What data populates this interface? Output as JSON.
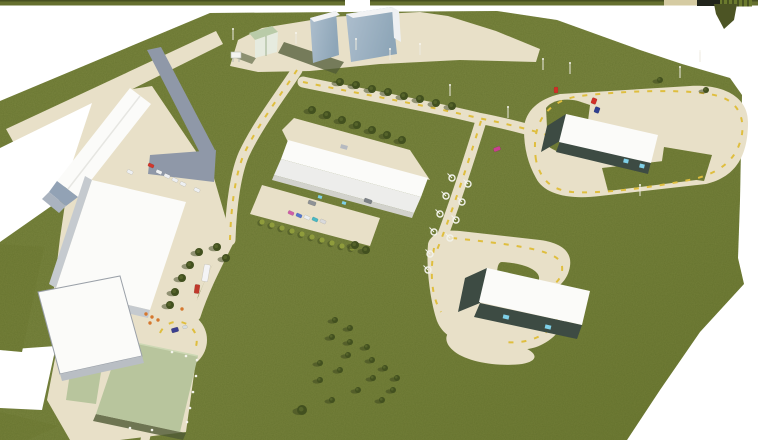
{
  "image_type": "aerial-3d-site-plan-rendering",
  "colors": {
    "background": "#ffffff",
    "grass": "#76813b",
    "grass_dark": "#68742f",
    "pad_green": "#b8c59d",
    "pavement": "#e8e0c8",
    "road_gray": "#8f98a8",
    "roof_white": "#fbfbf9",
    "roof_shaded": "#ededeb",
    "wall_gray": "#c5cacf",
    "wall_dark": "#3d4b43",
    "glass_blue": "#9db3c4",
    "roof_green": "#b9cba8",
    "marking_yellow": "#dfbe3e",
    "tree_dark": "#42501f",
    "tree_mid": "#55632a",
    "bush_yellow": "#8f9c3c",
    "shadow_dark": "#4f5a35",
    "bar_olive": "#66702f",
    "bar_tan": "#d5cba2",
    "bar_black": "#22251c",
    "door_glow": "#7fd0e8"
  },
  "scene": {
    "trees": [
      [
        340,
        82,
        4
      ],
      [
        356,
        85,
        4
      ],
      [
        372,
        89,
        4
      ],
      [
        388,
        92,
        4
      ],
      [
        404,
        96,
        4
      ],
      [
        420,
        99,
        4
      ],
      [
        436,
        103,
        4
      ],
      [
        452,
        106,
        4
      ],
      [
        312,
        110,
        4
      ],
      [
        327,
        115,
        4
      ],
      [
        342,
        120,
        4
      ],
      [
        357,
        125,
        4
      ],
      [
        372,
        130,
        4
      ],
      [
        387,
        135,
        4
      ],
      [
        402,
        140,
        4
      ],
      [
        199,
        252,
        4
      ],
      [
        190,
        265,
        4
      ],
      [
        182,
        278,
        4
      ],
      [
        175,
        292,
        4
      ],
      [
        170,
        305,
        4
      ],
      [
        217,
        247,
        4
      ],
      [
        226,
        258,
        4
      ],
      [
        355,
        245,
        4
      ],
      [
        366,
        250,
        4
      ],
      [
        335,
        320,
        3
      ],
      [
        350,
        328,
        3
      ],
      [
        332,
        337,
        3
      ],
      [
        350,
        342,
        3
      ],
      [
        367,
        347,
        3
      ],
      [
        348,
        355,
        3
      ],
      [
        372,
        360,
        3
      ],
      [
        320,
        363,
        3
      ],
      [
        385,
        368,
        3
      ],
      [
        340,
        370,
        3
      ],
      [
        373,
        378,
        3
      ],
      [
        397,
        378,
        3
      ],
      [
        320,
        380,
        3
      ],
      [
        358,
        390,
        3
      ],
      [
        393,
        390,
        3
      ],
      [
        332,
        400,
        3
      ],
      [
        382,
        400,
        3
      ],
      [
        302,
        410,
        5
      ],
      [
        660,
        80,
        3
      ],
      [
        706,
        90,
        3
      ]
    ],
    "bushes": [
      [
        262,
        222
      ],
      [
        272,
        225
      ],
      [
        282,
        228
      ],
      [
        292,
        231
      ],
      [
        302,
        234
      ],
      [
        312,
        237
      ],
      [
        322,
        240
      ],
      [
        332,
        243
      ],
      [
        342,
        246
      ],
      [
        352,
        248
      ]
    ],
    "lamps": [
      [
        452,
        178
      ],
      [
        446,
        196
      ],
      [
        440,
        214
      ],
      [
        434,
        232
      ],
      [
        468,
        184
      ],
      [
        462,
        202
      ],
      [
        456,
        220
      ],
      [
        450,
        238
      ],
      [
        430,
        254
      ],
      [
        428,
        270
      ]
    ],
    "poles": [
      [
        233,
        40
      ],
      [
        296,
        44
      ],
      [
        356,
        50
      ],
      [
        420,
        55
      ],
      [
        450,
        96
      ],
      [
        508,
        118
      ],
      [
        543,
        70
      ],
      [
        570,
        74
      ],
      [
        680,
        78
      ],
      [
        390,
        60
      ],
      [
        640,
        196
      ],
      [
        700,
        62
      ]
    ],
    "posts": [
      [
        172,
        352
      ],
      [
        186,
        356
      ],
      [
        197,
        360
      ],
      [
        196,
        376
      ],
      [
        193,
        392
      ],
      [
        190,
        408
      ],
      [
        187,
        422
      ],
      [
        152,
        430
      ],
      [
        130,
        428
      ]
    ],
    "flowers": [
      [
        146,
        314
      ],
      [
        152,
        317
      ],
      [
        158,
        320
      ],
      [
        150,
        323
      ],
      [
        182,
        309
      ]
    ],
    "vehicles": [
      {
        "n": "parking-car-pink",
        "x": 291,
        "y": 213,
        "w": 6,
        "h": 3.5,
        "a": 25,
        "c": "#cf5fa8"
      },
      {
        "n": "parking-car-blue",
        "x": 299,
        "y": 215.5,
        "w": 6,
        "h": 3.5,
        "a": 25,
        "c": "#5577cc"
      },
      {
        "n": "parking-car-white",
        "x": 307,
        "y": 217.5,
        "w": 6,
        "h": 3.5,
        "a": 25,
        "c": "#eceff1"
      },
      {
        "n": "parking-car-teal",
        "x": 315,
        "y": 219.5,
        "w": 6,
        "h": 3.5,
        "a": 25,
        "c": "#49b8c4"
      },
      {
        "n": "parking-car-silver",
        "x": 323,
        "y": 221.5,
        "w": 6,
        "h": 3.5,
        "a": 25,
        "c": "#d9dadc"
      },
      {
        "n": "gray-van",
        "x": 312,
        "y": 203,
        "w": 8,
        "h": 4,
        "a": 20,
        "c": "#8e9296"
      },
      {
        "n": "gray-van",
        "x": 368,
        "y": 201,
        "w": 8,
        "h": 4,
        "a": 20,
        "c": "#7d8287"
      },
      {
        "n": "red-car",
        "x": 151,
        "y": 165.5,
        "w": 6,
        "h": 3.5,
        "a": 25,
        "c": "#d2372c"
      },
      {
        "n": "white-car",
        "x": 130,
        "y": 172,
        "w": 6,
        "h": 3.5,
        "a": 25,
        "c": "#eef0f2"
      },
      {
        "n": "white-car",
        "x": 159,
        "y": 172,
        "w": 6,
        "h": 3.5,
        "a": 25,
        "c": "#eef0f2"
      },
      {
        "n": "white-car",
        "x": 167,
        "y": 176,
        "w": 6,
        "h": 3.5,
        "a": 25,
        "c": "#eef0f2"
      },
      {
        "n": "white-car",
        "x": 175,
        "y": 180,
        "w": 6,
        "h": 3.5,
        "a": 25,
        "c": "#eef0f2"
      },
      {
        "n": "white-car",
        "x": 183,
        "y": 184,
        "w": 6,
        "h": 3.5,
        "a": 25,
        "c": "#eef0f2"
      },
      {
        "n": "white-car",
        "x": 197,
        "y": 190,
        "w": 6,
        "h": 3.5,
        "a": 25,
        "c": "#eef0f2"
      },
      {
        "n": "white-truck",
        "x": 206,
        "y": 273,
        "w": 6,
        "h": 17,
        "a": 10,
        "c": "#f4f4f6"
      },
      {
        "n": "red-truck",
        "x": 197,
        "y": 289,
        "w": 5,
        "h": 9,
        "a": 8,
        "c": "#c0392b"
      },
      {
        "n": "plaza-car-blue",
        "x": 175,
        "y": 330,
        "w": 7,
        "h": 4.5,
        "a": -15,
        "c": "#3a3f8f"
      },
      {
        "n": "plaza-car-small",
        "x": 185,
        "y": 327,
        "w": 4.5,
        "h": 3,
        "a": -15,
        "c": "#d6dde0"
      },
      {
        "n": "magenta-car",
        "x": 497,
        "y": 149,
        "w": 7,
        "h": 4,
        "a": -20,
        "c": "#c9408f"
      },
      {
        "n": "red-marker",
        "x": 556,
        "y": 90,
        "w": 4,
        "h": 6,
        "a": 0,
        "c": "#d03028"
      },
      {
        "n": "red-marker",
        "x": 594,
        "y": 101,
        "w": 5,
        "h": 6,
        "a": 20,
        "c": "#d03028"
      },
      {
        "n": "blue-marker",
        "x": 597,
        "y": 110,
        "w": 5,
        "h": 6,
        "a": 20,
        "c": "#2f3f8f"
      }
    ]
  }
}
